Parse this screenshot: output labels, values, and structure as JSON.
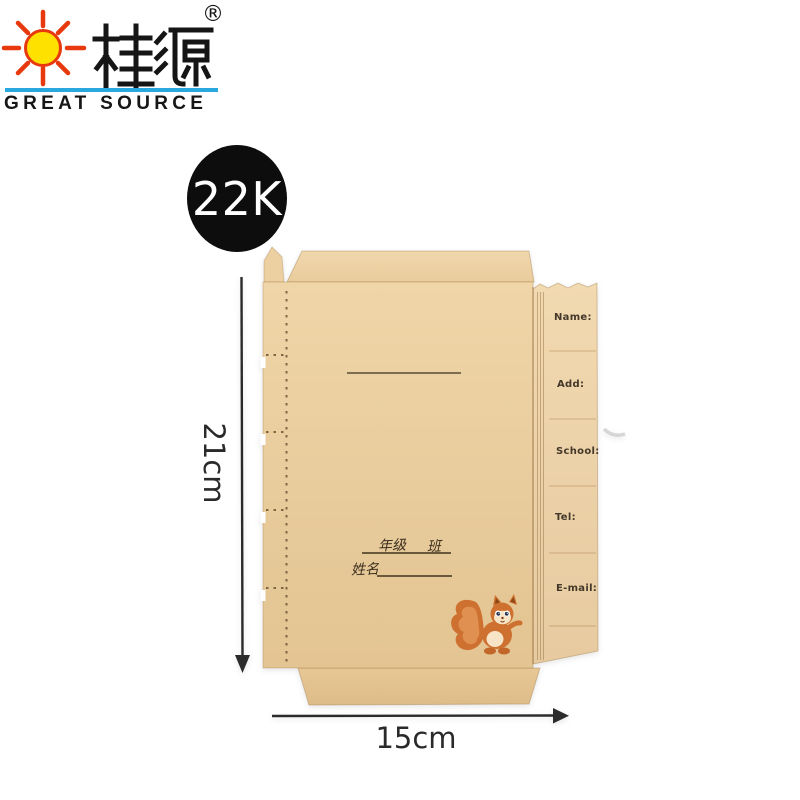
{
  "header": {
    "brand_chinese": "桂源",
    "brand_english": "GREAT SOURCE",
    "registered_mark": "®",
    "colors": {
      "sun_yellow": "#ffe100",
      "sun_red": "#e8380d",
      "divider_blue": "#29a8e0"
    }
  },
  "badge": {
    "label": "22K",
    "bg_color": "#0d0d0d",
    "text_color": "#ffffff"
  },
  "cover": {
    "description": "unfolded kraft paper book cover with fold flaps and perforation",
    "kraft_color": "#e9cda0",
    "fields": [
      {
        "label": "Name:"
      },
      {
        "label": "Add:"
      },
      {
        "label": "School:"
      },
      {
        "label": "Tel:"
      },
      {
        "label": "E-mail:"
      }
    ],
    "grade_label": "年级",
    "class_label": "班",
    "name_label": "姓名",
    "mascot": "squirrel-illustration",
    "mascot_color": "#ce7130"
  },
  "dimensions": {
    "height_label": "21cm",
    "width_label": "15cm"
  }
}
